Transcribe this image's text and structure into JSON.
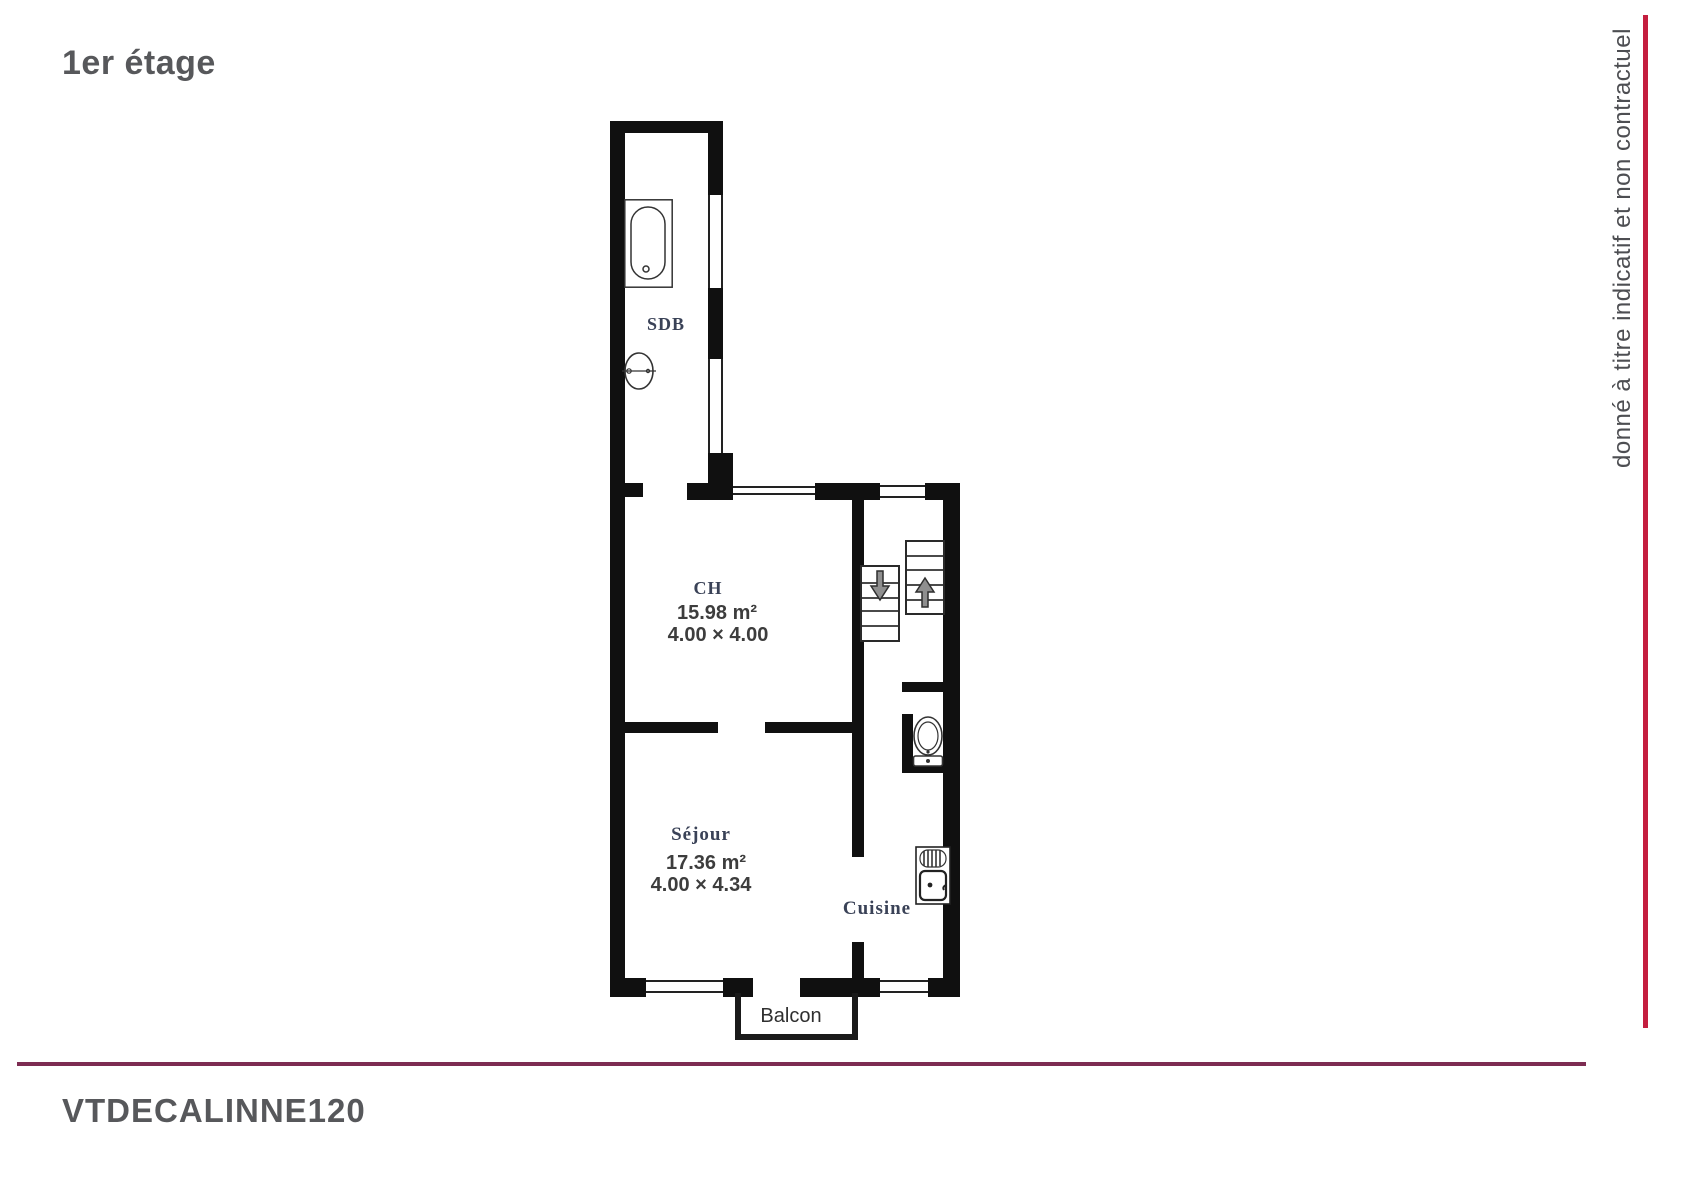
{
  "page": {
    "title": "1er étage",
    "reference_code": "VTDECALINNE120",
    "disclaimer": "donné à titre indicatif et non contractuel"
  },
  "floorplan": {
    "rooms": {
      "sdb": {
        "label": "SDB"
      },
      "ch": {
        "label": "CH",
        "area": "15.98 m²",
        "dims": "4.00 × 4.00"
      },
      "sejour": {
        "label": "Séjour",
        "area": "17.36 m²",
        "dims": "4.00 × 4.34"
      },
      "cuisine": {
        "label": "Cuisine"
      },
      "balcon": {
        "label": "Balcon"
      }
    },
    "fixtures": {
      "bathtub": "bathtub-icon",
      "washbasin": "washbasin-icon",
      "toilet": "toilet-icon",
      "kitchen_sink": "kitchen-sink-icon",
      "stairs_down": "stairs-down-arrow-icon",
      "stairs_up": "stairs-up-arrow-icon"
    },
    "colors": {
      "wall": "#101010",
      "accent_vertical_line": "#c41e3f",
      "accent_horizontal_line": "#7d2c52",
      "title_text": "#57585b",
      "room_label_text": "#3a4257"
    }
  }
}
